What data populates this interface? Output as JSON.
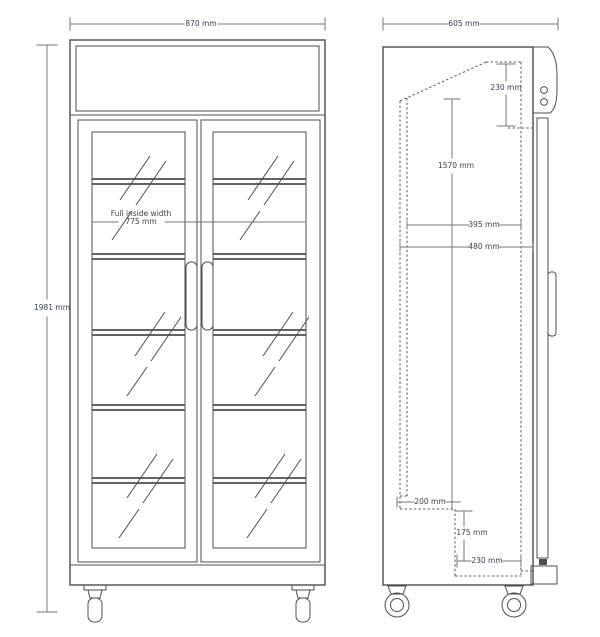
{
  "drawing": {
    "subject": "upright two glass-door display fridge, front and side elevations",
    "front_view": {
      "overall_width": "870 mm",
      "overall_height": "1981 mm",
      "inside_width_caption": "Full inside width",
      "inside_width_value": "775 mm",
      "door_count": 2,
      "shelf_count": 5
    },
    "side_view": {
      "overall_depth": "605 mm",
      "header_height": "230 mm",
      "interior_height": "1570 mm",
      "upper_depth": "395 mm",
      "mid_depth": "480 mm",
      "base_recess_depth": "200 mm",
      "base_recess_height": "175 mm",
      "base_front_depth": "230 mm"
    },
    "colors": {
      "line": "#4d4d4d",
      "dimension_line": "#767676",
      "text": "#374151",
      "background": "#ffffff"
    }
  }
}
